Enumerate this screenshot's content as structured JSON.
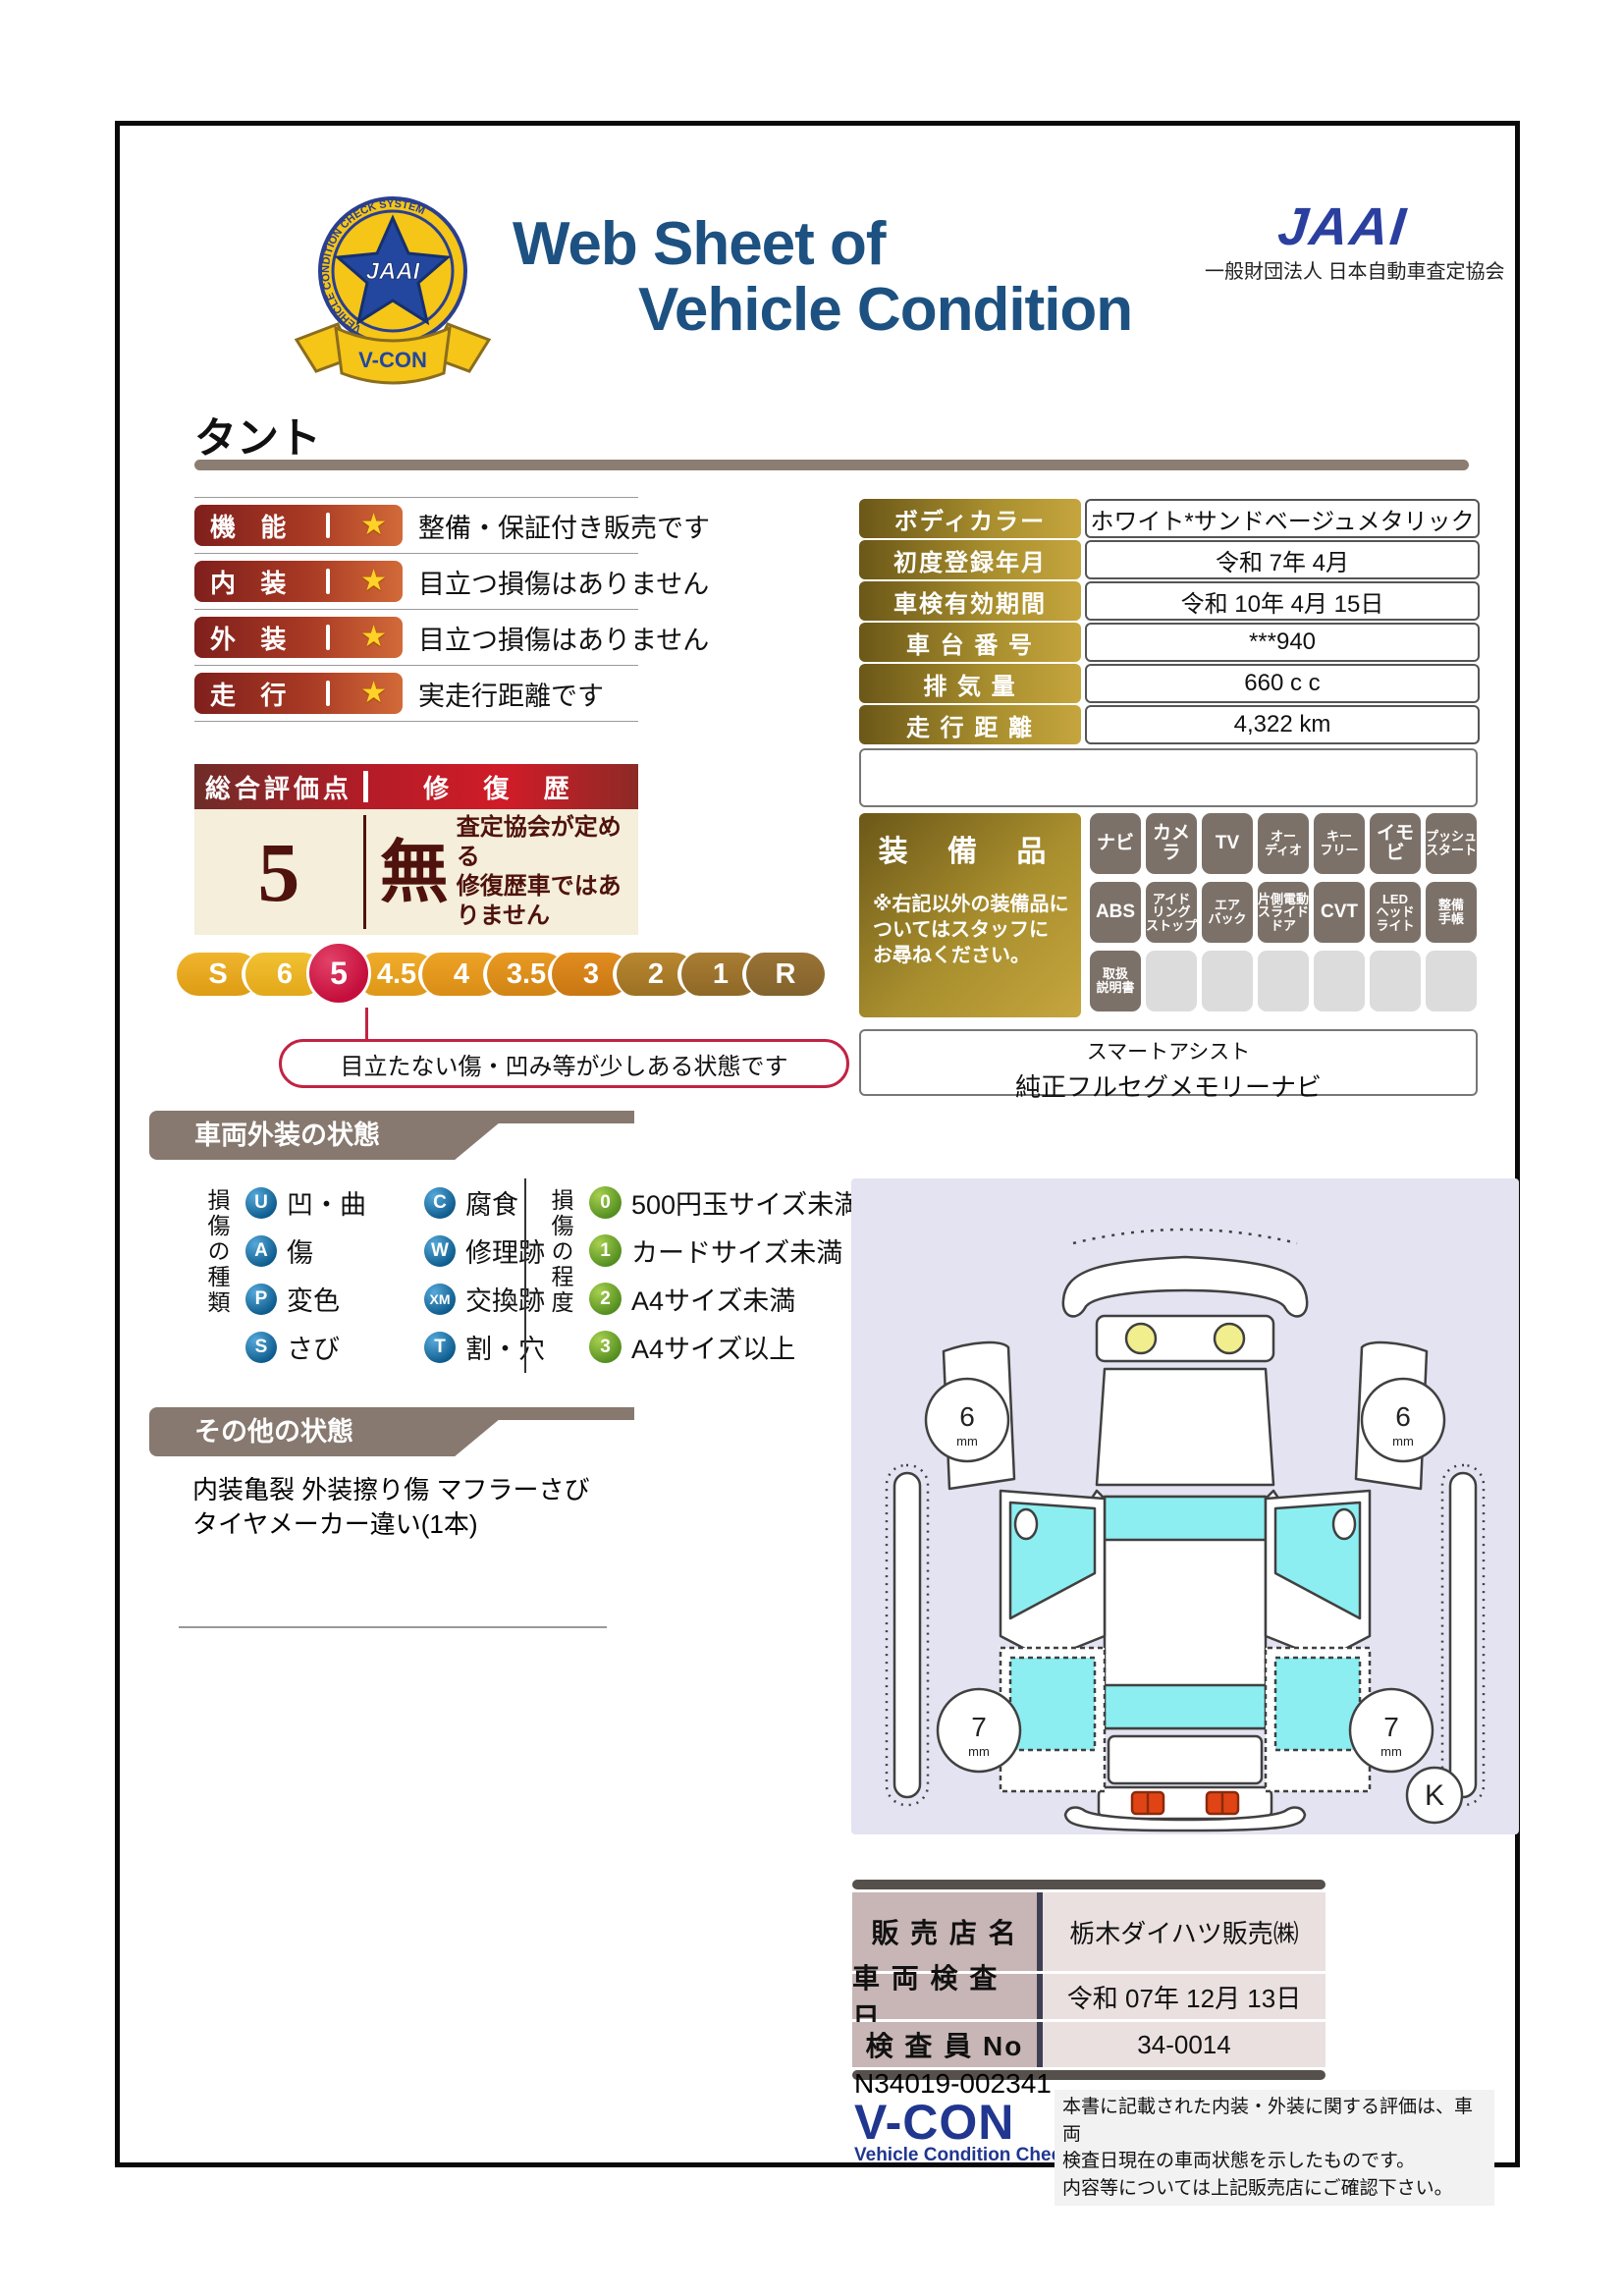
{
  "header": {
    "title_line1": "Web Sheet of",
    "title_line2": "Vehicle Condition",
    "jaai_logo": "JAAI",
    "jaai_subtitle": "一般財団法人 日本自動車査定協会",
    "emblem": {
      "badge_text": "JAAI",
      "ring_text": "VEHICLE CONDITION CHECK SYSTEM",
      "ribbon_text": "V-CON"
    }
  },
  "model_name": "タント",
  "ratings": {
    "items": [
      {
        "label": "機 能",
        "star": "★",
        "comment": "整備・保証付き販売です"
      },
      {
        "label": "内 装",
        "star": "★",
        "comment": "目立つ損傷はありません"
      },
      {
        "label": "外 装",
        "star": "★",
        "comment": "目立つ損傷はありません"
      },
      {
        "label": "走 行",
        "star": "★",
        "comment": "実走行距離です"
      }
    ]
  },
  "overall": {
    "header_left": "総合評価点",
    "header_right": "修 復 歴",
    "score": "5",
    "repair_status": "無",
    "repair_note": "査定協会が定める\n修復歴車ではありません",
    "scale": [
      "S",
      "6",
      "5",
      "4.5",
      "4",
      "3.5",
      "3",
      "2",
      "1",
      "R"
    ],
    "bubble": "目立たない傷・凹み等が少しある状態です"
  },
  "vehicle_info": {
    "rows": [
      {
        "label": "ボディカラー",
        "value": "ホワイト*サンドベージュメタリック"
      },
      {
        "label": "初度登録年月",
        "value": "令和 7年 4月"
      },
      {
        "label": "車検有効期間",
        "value": "令和 10年 4月 15日"
      },
      {
        "label": "車 台 番 号",
        "value": "***940"
      },
      {
        "label": "排 気 量",
        "value": "660 c c"
      },
      {
        "label": "走 行 距 離",
        "value": "4,322 km"
      }
    ]
  },
  "equipment": {
    "title": "装 備 品",
    "note": "※右記以外の装備品に\nついてはスタッフに\nお尋ねください。",
    "items": [
      {
        "label": "ナビ"
      },
      {
        "label": "カメラ"
      },
      {
        "label": "TV"
      },
      {
        "label": "オー\nディオ"
      },
      {
        "label": "キー\nフリー"
      },
      {
        "label": "イモビ"
      },
      {
        "label": "プッシュ\nスタート"
      },
      {
        "label": "ABS"
      },
      {
        "label": "アイド\nリング\nストップ"
      },
      {
        "label": "エア\nバック"
      },
      {
        "label": "片側電動\nスライド\nドア"
      },
      {
        "label": "CVT"
      },
      {
        "label": "LED\nヘッド\nライト"
      },
      {
        "label": "整備\n手帳"
      },
      {
        "label": "取扱\n説明書"
      },
      {
        "label": ""
      },
      {
        "label": ""
      },
      {
        "label": ""
      },
      {
        "label": ""
      },
      {
        "label": ""
      },
      {
        "label": ""
      }
    ],
    "extra_line1": "スマートアシスト",
    "extra_line2": "純正フルセグメモリーナビ"
  },
  "exterior": {
    "section_title": "車両外装の状態",
    "type_axis": "損傷の種類",
    "types": [
      {
        "code": "U",
        "label": "凹・曲"
      },
      {
        "code": "C",
        "label": "腐食"
      },
      {
        "code": "A",
        "label": "傷"
      },
      {
        "code": "W",
        "label": "修理跡"
      },
      {
        "code": "P",
        "label": "変色"
      },
      {
        "code": "XM",
        "label": "交換跡"
      },
      {
        "code": "S",
        "label": "さび"
      },
      {
        "code": "T",
        "label": "割・穴"
      }
    ],
    "degree_axis": "損傷の程度",
    "degrees": [
      {
        "code": "0",
        "label": "500円玉サイズ未満"
      },
      {
        "code": "1",
        "label": "カードサイズ未満"
      },
      {
        "code": "2",
        "label": "A4サイズ未満"
      },
      {
        "code": "3",
        "label": "A4サイズ以上"
      }
    ]
  },
  "other": {
    "section_title": "その他の状態",
    "notes": "内装亀裂 外装擦り傷 マフラーさび\nタイヤメーカー違い(1本)"
  },
  "diagram": {
    "tires": {
      "front_left": "6",
      "front_right": "6",
      "rear_left": "7",
      "rear_right": "7",
      "unit": "mm"
    },
    "marker": "K"
  },
  "dealer": {
    "rows": [
      {
        "label": "販 売 店 名",
        "value": "栃木ダイハツ販売㈱"
      },
      {
        "label": "車 両 検 査 日",
        "value": "令和 07年 12月 13日"
      },
      {
        "label": "検 査 員 No",
        "value": "34-0014"
      }
    ]
  },
  "footer": {
    "serial": "N34019-002341",
    "vcon_logo": "V-CON",
    "vcon_subtitle": "Vehicle Condition Check System",
    "disclaimer": "本書に記載された内装・外装に関する評価は、車両\n検査日現在の車両状態を示したものです。\n内容等については上記販売店にご確認下さい。"
  }
}
